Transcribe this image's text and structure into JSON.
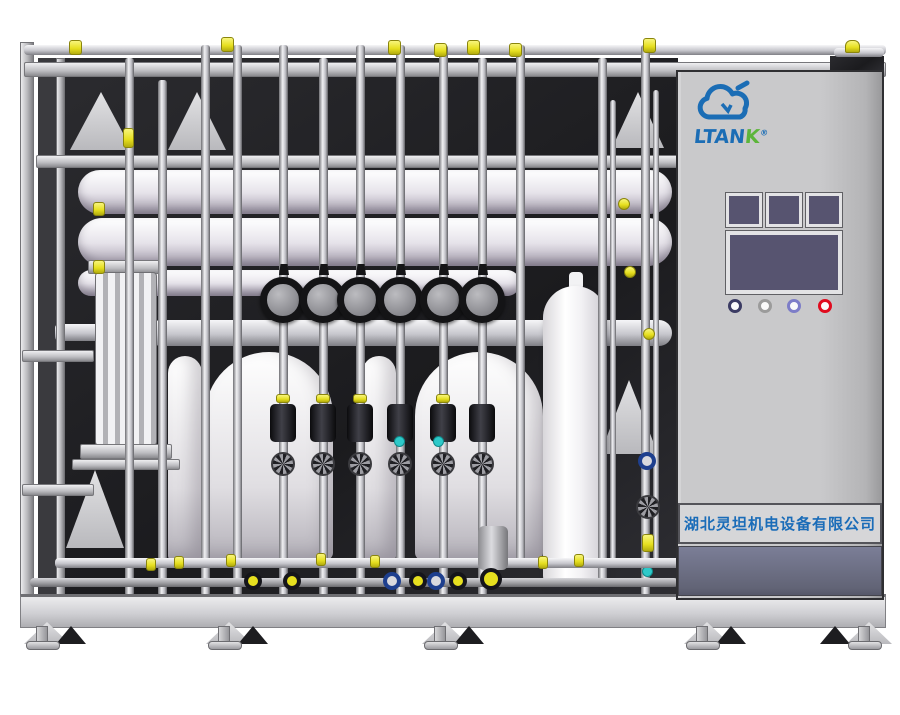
{
  "brand": {
    "logo_icon": "cloud-logo-icon",
    "name_main": "LTAN",
    "name_accent": "K",
    "registered": "®"
  },
  "cabinet": {
    "company_label": "湖北灵坦机电设备有限公司",
    "small_screens": 3,
    "main_screens": 1,
    "indicator_lamps": 4
  },
  "colors": {
    "brand_blue": "#1b6db5",
    "brand_green": "#5cb53a",
    "company_text": "#1a6cb8",
    "screen_purple": "#575470",
    "lamp_rings": [
      "#3b3b63",
      "#9b9b9b",
      "#7d7dc8",
      "#e00b1e"
    ],
    "valve_yellow": "#e6df1f",
    "sensor_cyan": "#2ec9c9",
    "knob_blue": "#1e3f8e",
    "cabinet_gray": "#c9c9cb",
    "frame_gray": "#c6c6c8",
    "shadow_dark": "#1d1d20",
    "vessel_white": "#f4f3f6",
    "dark_band": "#6b6e84"
  }
}
